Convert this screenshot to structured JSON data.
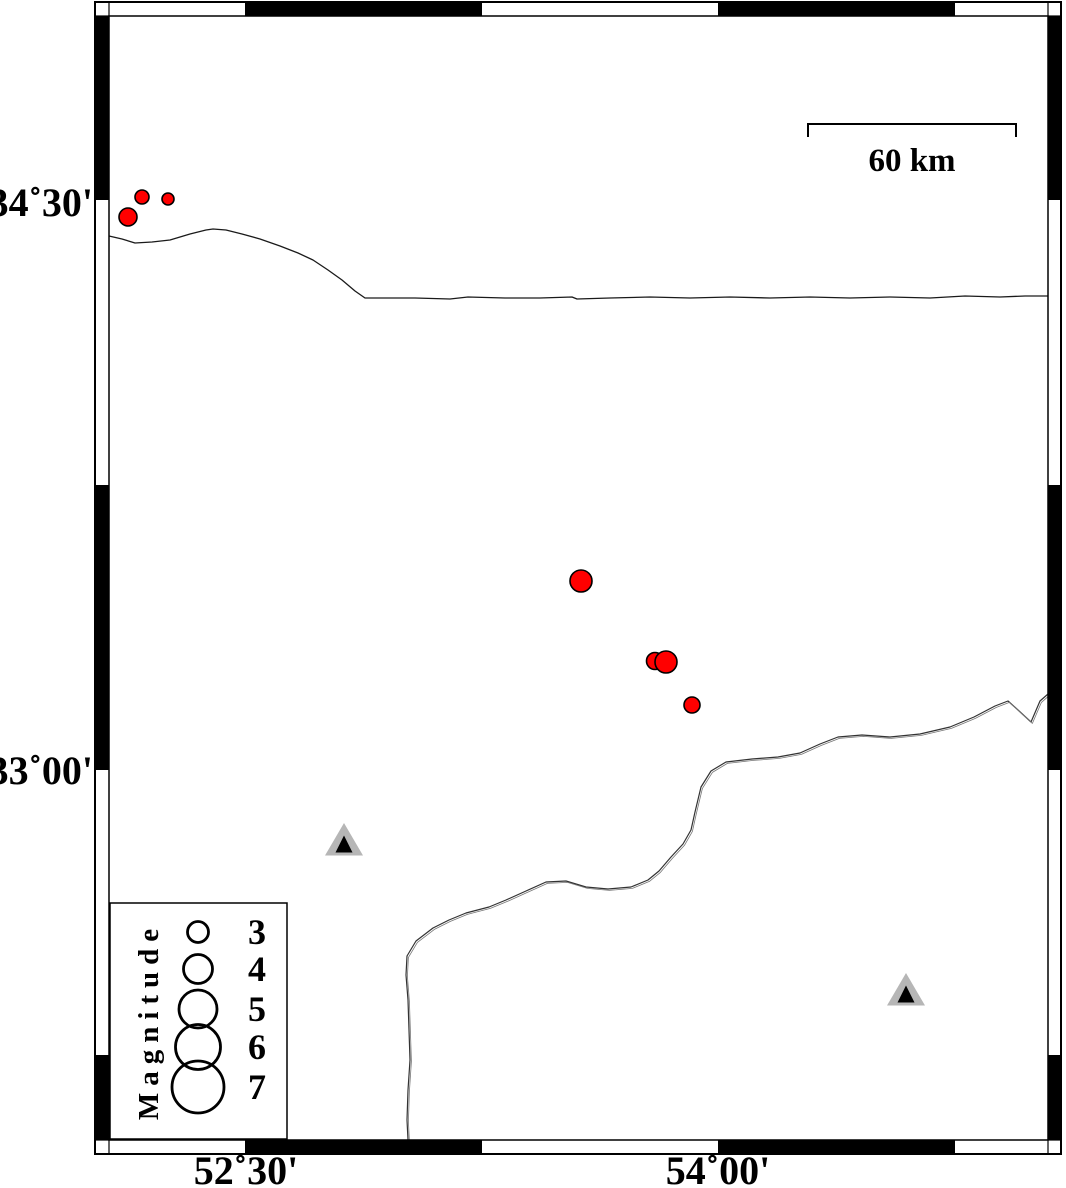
{
  "figure": {
    "width": 1066,
    "height": 1188,
    "background": "#ffffff"
  },
  "axes": {
    "y_tick_labels": [
      {
        "text": "34˚30'",
        "y": 202
      },
      {
        "text": "33˚00'",
        "y": 770
      }
    ],
    "x_tick_labels": [
      {
        "text": "52˚30'",
        "x": 246
      },
      {
        "text": "54˚00'",
        "x": 718
      }
    ],
    "x_segment_bounds": [
      245,
      482,
      718,
      955
    ],
    "y_segment_bounds": [
      200,
      485,
      770,
      1055
    ]
  },
  "scale_bar": {
    "label": "60 km",
    "x1": 808,
    "x2": 1016,
    "y": 124,
    "tick_drop": 13,
    "label_x": 912,
    "label_y": 171
  },
  "legend": {
    "title": "Magnitude",
    "box": {
      "x": 110,
      "y": 903,
      "w": 177,
      "h": 236
    },
    "symbol_cx": 198,
    "label_x": 257,
    "entries": [
      {
        "label": "3",
        "cy": 932,
        "r": 10.5
      },
      {
        "label": "4",
        "cy": 969,
        "r": 14.5
      },
      {
        "label": "5",
        "cy": 1009,
        "r": 19
      },
      {
        "label": "6",
        "cy": 1047,
        "r": 22.5
      },
      {
        "label": "7",
        "cy": 1087,
        "r": 26
      }
    ]
  },
  "earthquakes": {
    "color": "#ff0000",
    "outline": "#000000",
    "points": [
      {
        "x": 128,
        "y": 217,
        "r": 9
      },
      {
        "x": 142,
        "y": 197,
        "r": 7
      },
      {
        "x": 168,
        "y": 199,
        "r": 6
      },
      {
        "x": 581,
        "y": 581,
        "r": 11
      },
      {
        "x": 655,
        "y": 661,
        "r": 8.5
      },
      {
        "x": 666,
        "y": 662,
        "r": 11
      },
      {
        "x": 692,
        "y": 705,
        "r": 8
      }
    ]
  },
  "stations": {
    "fill": "#b6b6b6",
    "core": "#000000",
    "points": [
      {
        "x": 344,
        "y": 841
      },
      {
        "x": 906,
        "y": 991
      }
    ]
  },
  "map_lines": {
    "coastline": [
      [
        109,
        236
      ],
      [
        122,
        239
      ],
      [
        135,
        243
      ],
      [
        152,
        242
      ],
      [
        170,
        240
      ],
      [
        190,
        234
      ],
      [
        206,
        230
      ],
      [
        213,
        229
      ],
      [
        226,
        230
      ],
      [
        242,
        234
      ],
      [
        260,
        239
      ],
      [
        280,
        246
      ],
      [
        298,
        253
      ],
      [
        313,
        260
      ],
      [
        328,
        270
      ],
      [
        342,
        280
      ],
      [
        355,
        291
      ],
      [
        365,
        298
      ],
      [
        385,
        298
      ],
      [
        415,
        298
      ],
      [
        450,
        299
      ],
      [
        468,
        297
      ],
      [
        505,
        298
      ],
      [
        540,
        298
      ],
      [
        572,
        297
      ],
      [
        577,
        299
      ],
      [
        610,
        298
      ],
      [
        650,
        297
      ],
      [
        690,
        298
      ],
      [
        730,
        297
      ],
      [
        770,
        298
      ],
      [
        810,
        297
      ],
      [
        850,
        298
      ],
      [
        890,
        297
      ],
      [
        930,
        298
      ],
      [
        965,
        296
      ],
      [
        1000,
        297
      ],
      [
        1025,
        296
      ],
      [
        1048,
        296
      ]
    ],
    "border": [
      [
        1048,
        694
      ],
      [
        1040,
        701
      ],
      [
        1031,
        722
      ],
      [
        1018,
        710
      ],
      [
        1008,
        701
      ],
      [
        995,
        706
      ],
      [
        974,
        717
      ],
      [
        950,
        727
      ],
      [
        920,
        734
      ],
      [
        890,
        737
      ],
      [
        862,
        735
      ],
      [
        838,
        737
      ],
      [
        820,
        744
      ],
      [
        800,
        753
      ],
      [
        778,
        757
      ],
      [
        752,
        759
      ],
      [
        726,
        762
      ],
      [
        711,
        771
      ],
      [
        701,
        787
      ],
      [
        695,
        812
      ],
      [
        691,
        830
      ],
      [
        683,
        844
      ],
      [
        671,
        857
      ],
      [
        659,
        871
      ],
      [
        648,
        880
      ],
      [
        631,
        887
      ],
      [
        608,
        889
      ],
      [
        586,
        887
      ],
      [
        566,
        881
      ],
      [
        546,
        882
      ],
      [
        526,
        891
      ],
      [
        506,
        900
      ],
      [
        489,
        907
      ],
      [
        466,
        913
      ],
      [
        449,
        920
      ],
      [
        433,
        928
      ],
      [
        416,
        941
      ],
      [
        407,
        956
      ],
      [
        406,
        975
      ],
      [
        408,
        1000
      ],
      [
        409,
        1030
      ],
      [
        410,
        1060
      ],
      [
        408,
        1090
      ],
      [
        407,
        1120
      ],
      [
        408,
        1140
      ]
    ]
  },
  "frame": {
    "outer": {
      "x": 95,
      "y": 2,
      "w": 966,
      "h": 1152
    },
    "inner": {
      "x": 109,
      "y": 16,
      "w": 939,
      "h": 1124
    },
    "band": 13
  }
}
